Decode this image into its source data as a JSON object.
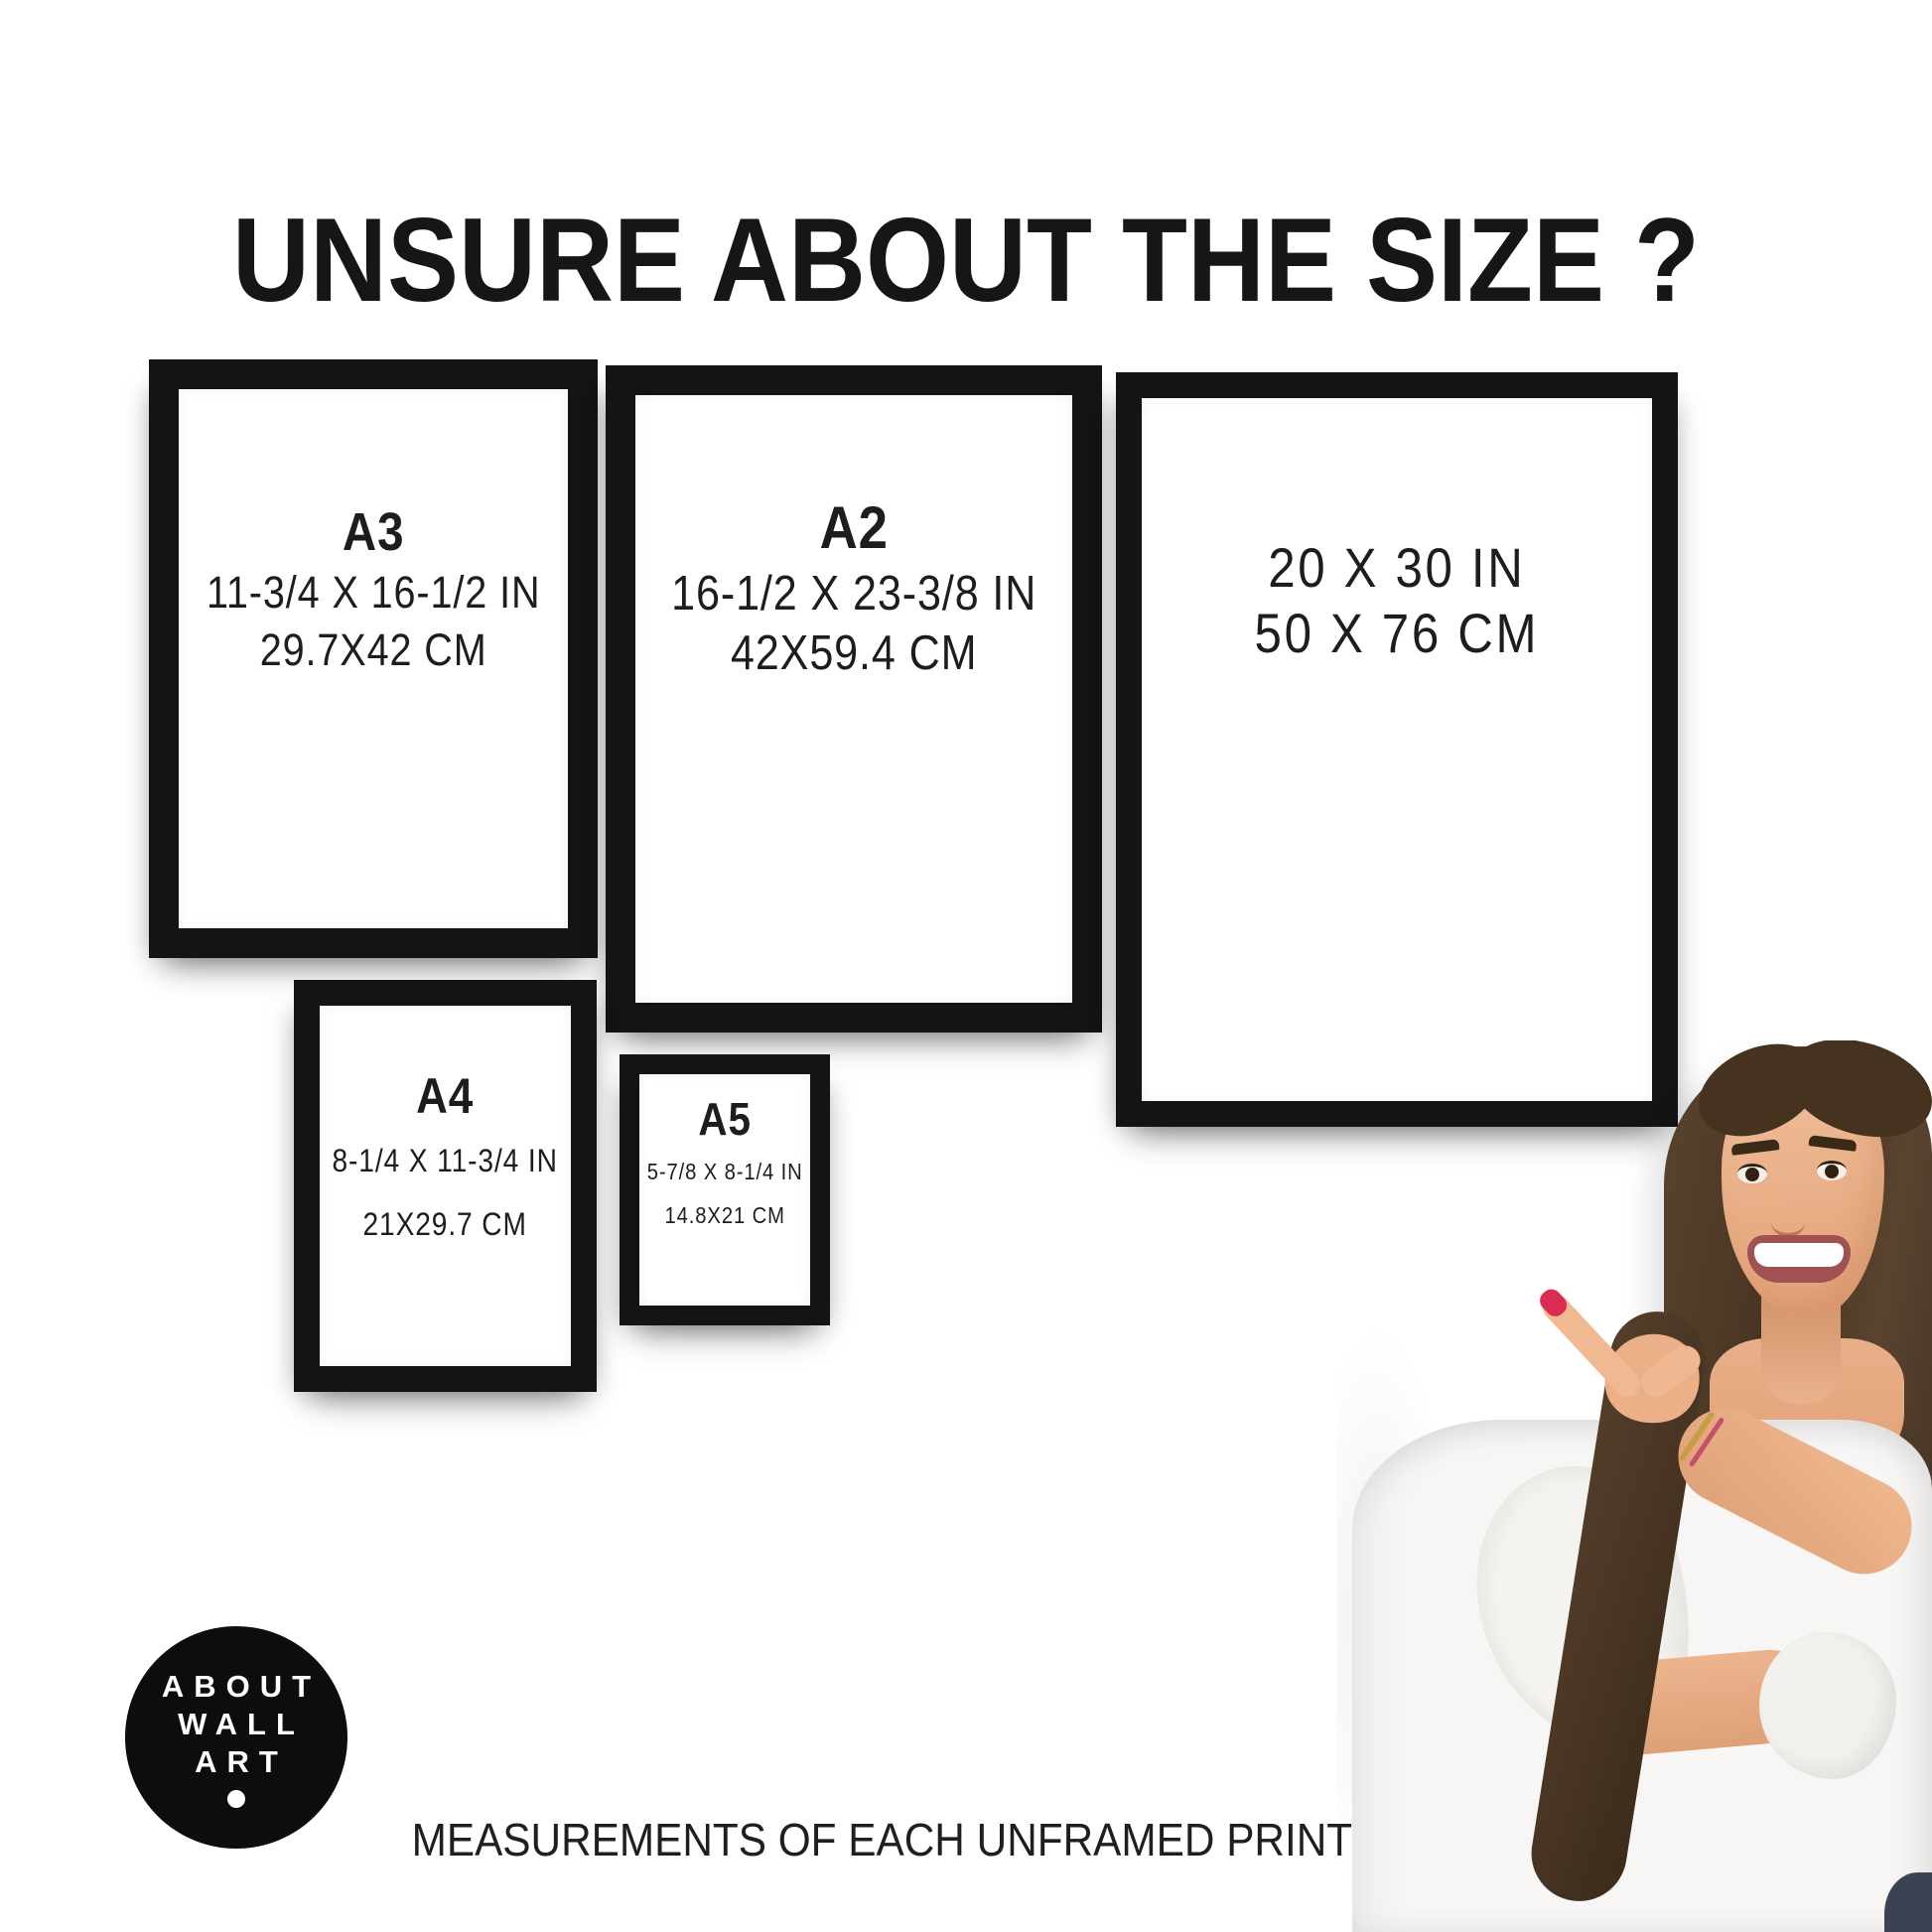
{
  "title": "UNSURE ABOUT THE SIZE ?",
  "footer": "MEASUREMENTS OF EACH UNFRAMED PRINT/POSTER",
  "logo": {
    "lines": [
      "ABOUT",
      "WALL",
      "ART"
    ]
  },
  "frames": [
    {
      "label": "A3",
      "inches": "11-3/4 X 16-1/2 IN",
      "cm": "29.7X42 CM"
    },
    {
      "label": "A2",
      "inches": "16-1/2 X 23-3/8 IN",
      "cm": "42X59.4 CM"
    },
    {
      "label": null,
      "inches": "20 X 30 IN",
      "cm": "50 X 76 CM"
    },
    {
      "label": "A4",
      "inches": "8-1/4 X 11-3/4 IN",
      "cm": "21X29.7 CM"
    },
    {
      "label": "A5",
      "inches": "5-7/8 X 8-1/4 IN",
      "cm": "14.8X21 CM"
    }
  ],
  "colors": {
    "background": "#ffffff",
    "frame": "#141414",
    "text": "#1d1d1d",
    "logo_bg": "#0d0d0d",
    "logo_text": "#ffffff",
    "nail_polish": "#da2b52",
    "hair": "#46331f",
    "skin": "#eab28c",
    "blouse": "#f7f6f4"
  }
}
